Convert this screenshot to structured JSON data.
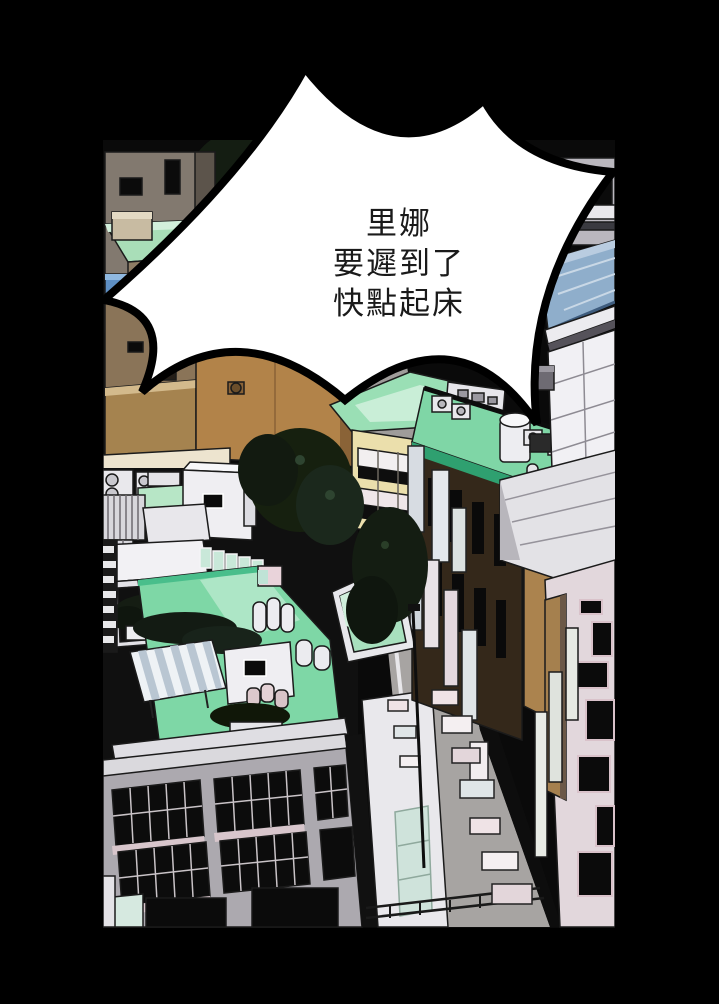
{
  "page": {
    "type": "comic-panel-page",
    "background_color": "#000000"
  },
  "speech_bubble": {
    "shape": "starburst",
    "fill_color": "#ffffff",
    "outline_color": "#000000",
    "text_color": "#1a1a1a",
    "lines": [
      "里娜",
      "要遲到了",
      "快點起床"
    ]
  },
  "panel": {
    "description": "aerial bird's-eye view of city rooftops along a diagonal street",
    "palette": {
      "mint_roof": "#7ED7A6",
      "mint_light": "#C9EED7",
      "green_deep": "#2FA070",
      "white_wall": "#EFEEF2",
      "gray_facade": "#ACA9AF",
      "cream_wall": "#EBDFAC",
      "tan_building": "#B28349",
      "brown_building": "#8A7458",
      "dark_building": "#34281A",
      "blue_glass": "#8FAECB",
      "blue_awning": "#5E8FC4",
      "street_gray": "#A7A4A2",
      "teal_glass": "#CFE3DB",
      "pink_trim": "#D8C6CC",
      "tree_dark": "#141D12",
      "window_black": "#0B0B0B"
    },
    "elements": [
      "street",
      "left-apartment-block",
      "green-roof-house",
      "blue-awning",
      "tan-building",
      "rooftop-deck",
      "striped-awning",
      "rooftop-hut",
      "water-tanks",
      "ac-units",
      "glass-railing",
      "plants",
      "trees",
      "dark-brown-building",
      "roof-garden",
      "blue-glass-roof",
      "grid-window-facade",
      "office-facade-windows",
      "storefronts",
      "street-signboards",
      "street-lamp",
      "stair-glass",
      "railing"
    ]
  }
}
